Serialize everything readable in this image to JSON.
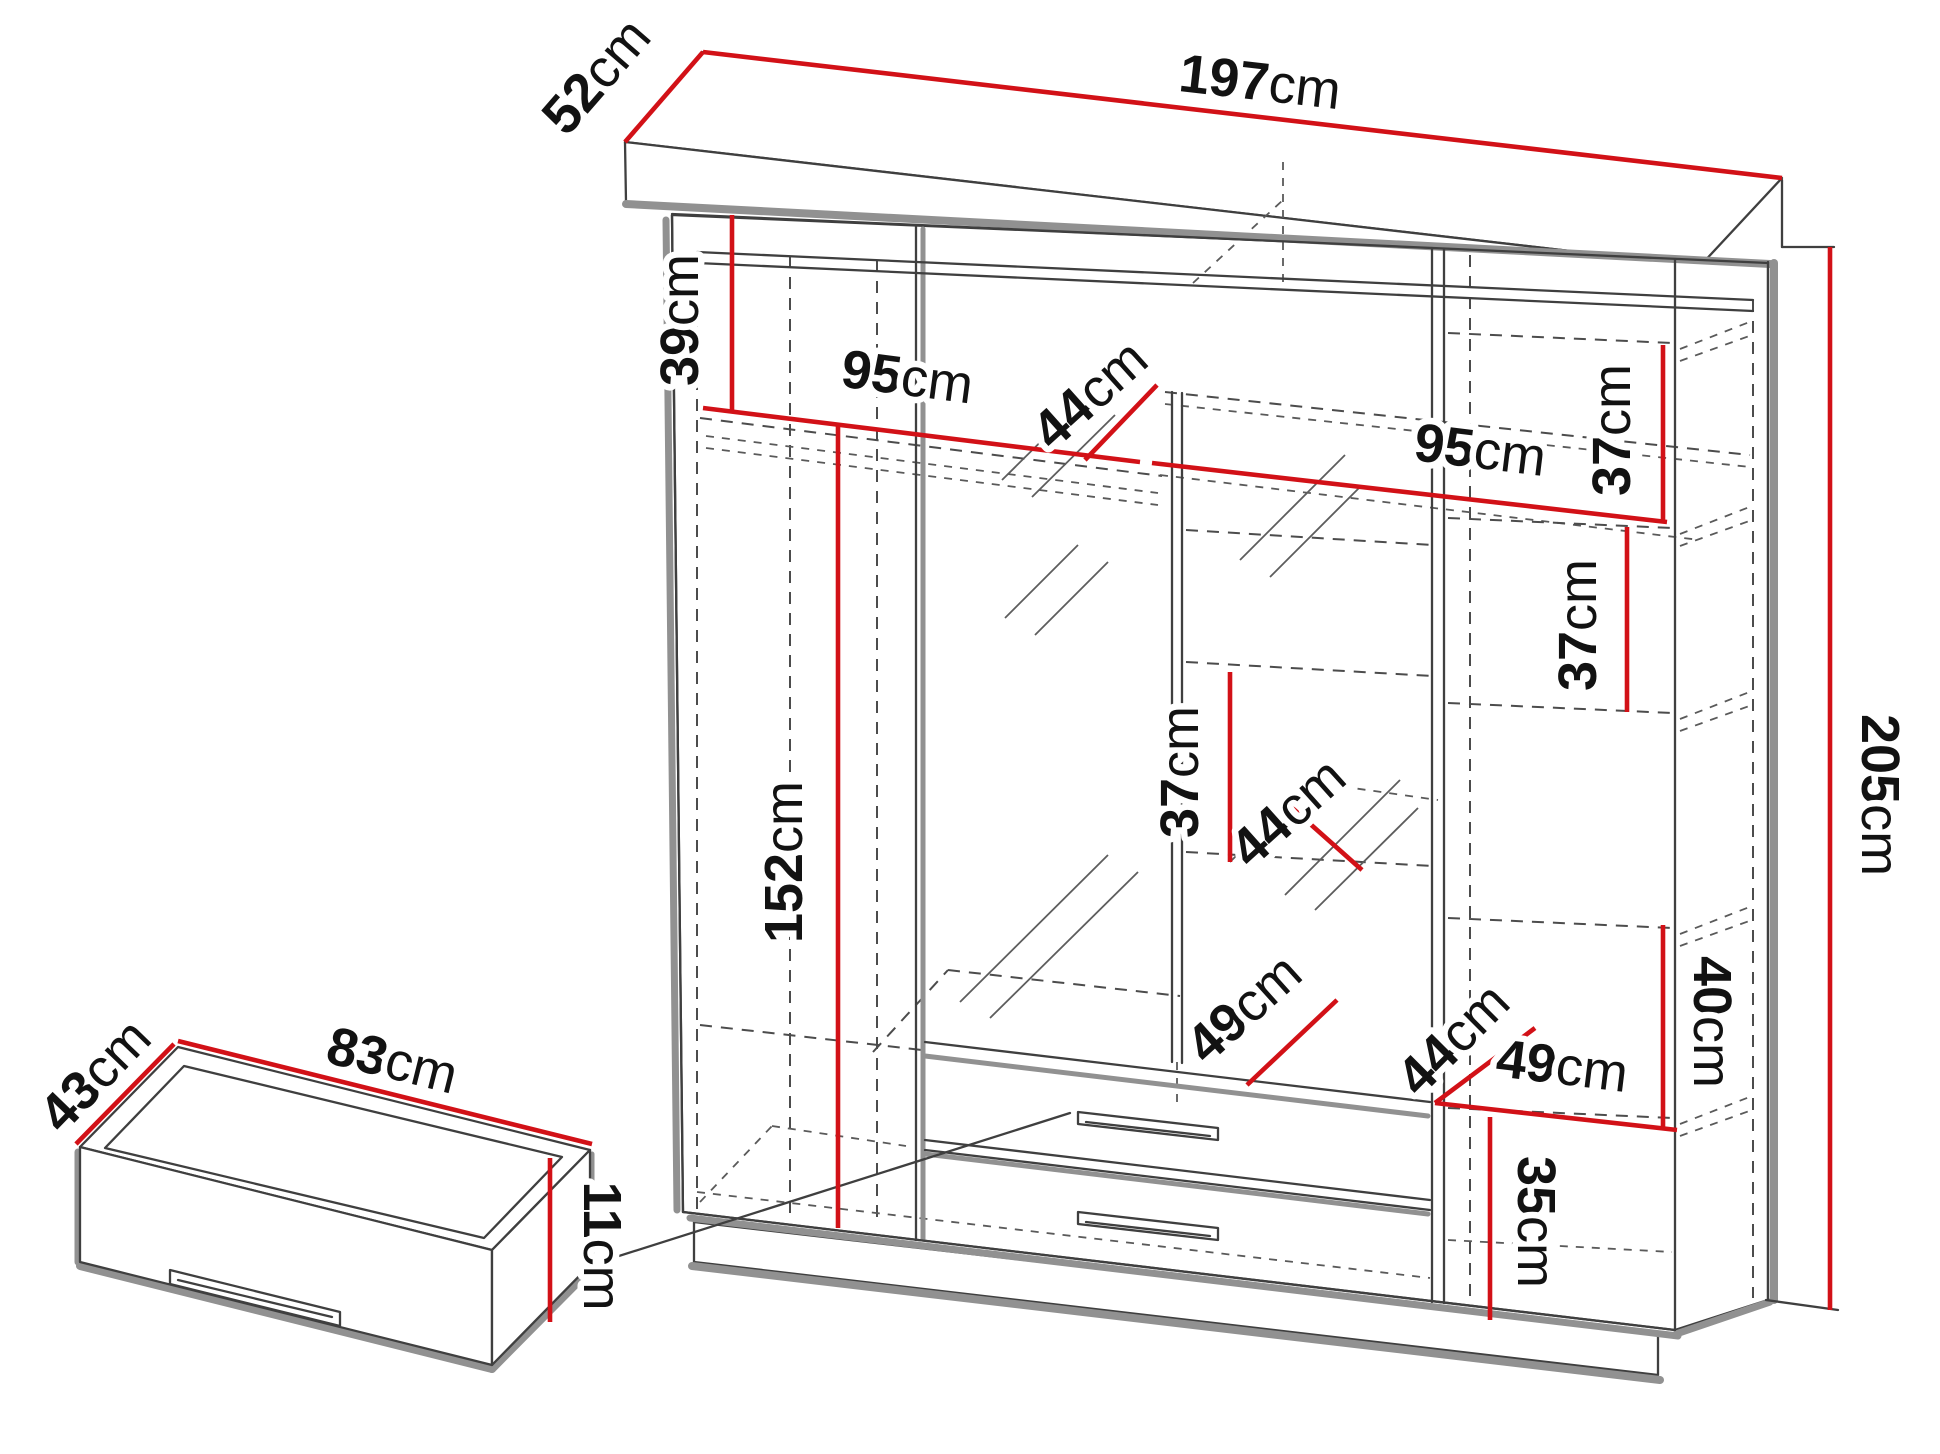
{
  "diagram": {
    "type": "wardrobe-dimension-drawing",
    "colors": {
      "dimension": "#d21117",
      "outline": "#3f3f3f",
      "shadow": "#919191",
      "ink": "#121212",
      "background": "#ffffff"
    },
    "dimensions": {
      "width": {
        "num": "197",
        "unit": "cm"
      },
      "depth": {
        "num": "52",
        "unit": "cm"
      },
      "upper_section": {
        "num": "39",
        "unit": "cm"
      },
      "left_opening": {
        "num": "95",
        "unit": "cm"
      },
      "upper_shelf_depth": {
        "num": "44",
        "unit": "cm"
      },
      "right_opening": {
        "num": "95",
        "unit": "cm"
      },
      "right_shelf_1": {
        "num": "37",
        "unit": "cm"
      },
      "right_shelf_2": {
        "num": "37",
        "unit": "cm"
      },
      "middle_shelf": {
        "num": "37",
        "unit": "cm"
      },
      "hanging_section": {
        "num": "152",
        "unit": "cm"
      },
      "middle_shelf_depth": {
        "num": "44",
        "unit": "cm"
      },
      "height": {
        "num": "205",
        "unit": "cm"
      },
      "right_lower_section": {
        "num": "40",
        "unit": "cm"
      },
      "drawer_opening": {
        "num": "49",
        "unit": "cm"
      },
      "lower_shelf_depth": {
        "num": "44",
        "unit": "cm"
      },
      "lower_right_opening": {
        "num": "49",
        "unit": "cm"
      },
      "plinth_section": {
        "num": "35",
        "unit": "cm"
      },
      "drawer_box_width": {
        "num": "83",
        "unit": "cm"
      },
      "drawer_box_depth": {
        "num": "43",
        "unit": "cm"
      },
      "drawer_box_height": {
        "num": "11",
        "unit": "cm"
      }
    }
  }
}
